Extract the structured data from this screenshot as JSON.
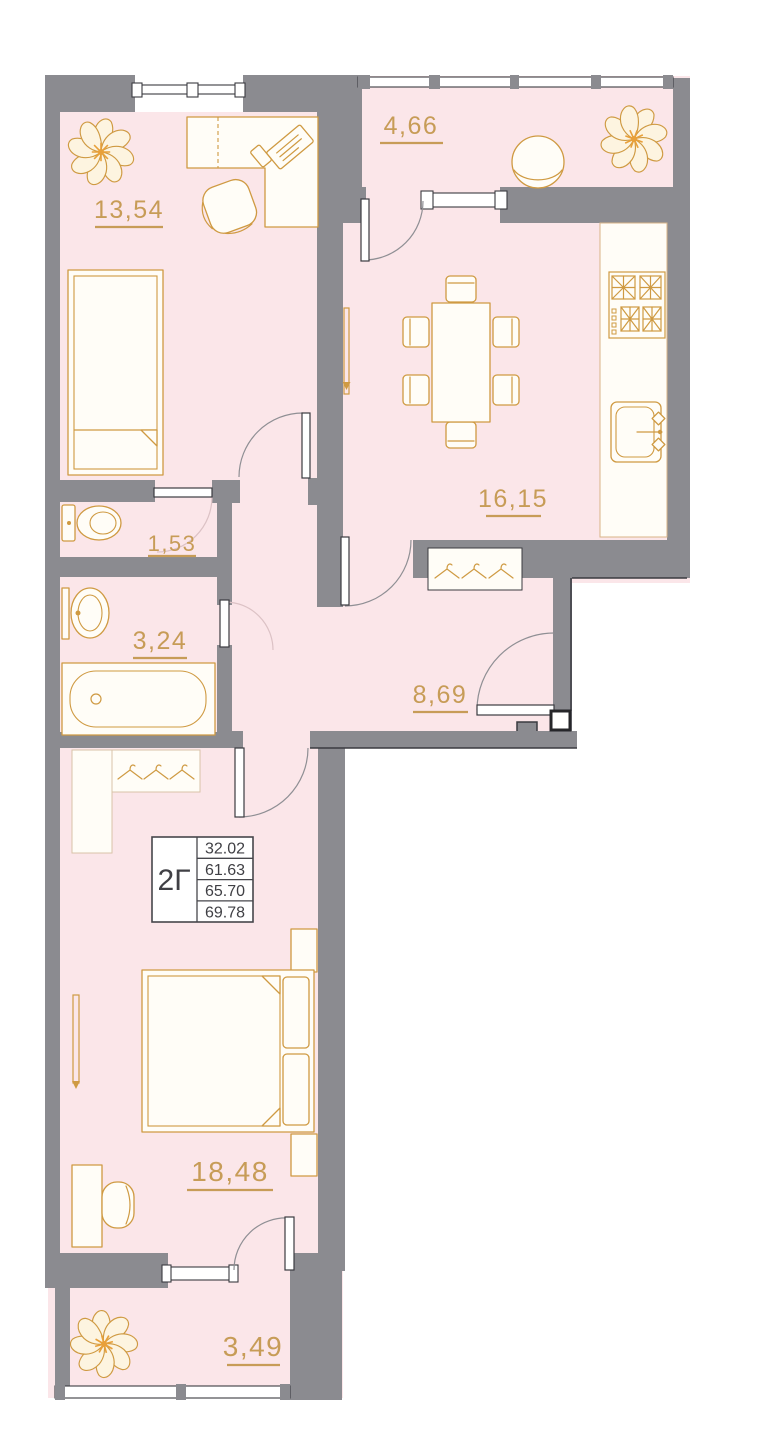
{
  "plan": {
    "unit": {
      "label": "2Г"
    },
    "areas_table": [
      "32.02",
      "61.63",
      "65.70",
      "69.78"
    ],
    "rooms": [
      {
        "name": "room-13-54",
        "area": "13,54"
      },
      {
        "name": "balcony-top",
        "area": "4,66"
      },
      {
        "name": "kitchen",
        "area": "16,15"
      },
      {
        "name": "wc",
        "area": "1,53"
      },
      {
        "name": "bathroom",
        "area": "3,24"
      },
      {
        "name": "hallway",
        "area": "8,69"
      },
      {
        "name": "bedroom",
        "area": "18,48"
      },
      {
        "name": "balcony-bottom",
        "area": "3,49"
      }
    ],
    "colors": {
      "wall": "#8b8b90",
      "room_fill": "#fbe6e9",
      "furniture_stroke": "#cf9a42",
      "label_text": "#c79c57",
      "table_text": "#404045"
    }
  }
}
